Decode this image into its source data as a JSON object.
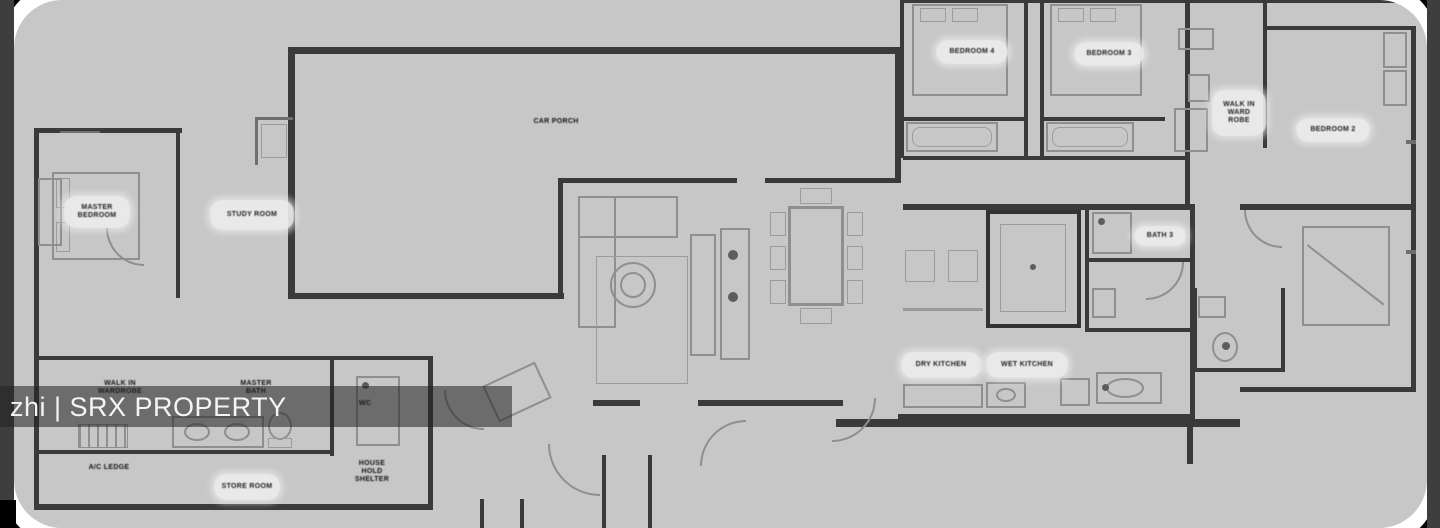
{
  "watermark": {
    "text": "zhi | SRX PROPERTY"
  },
  "plan": {
    "labels": {
      "hall": "CAR PORCH",
      "study": "STUDY ROOM",
      "master_bedroom": [
        "MASTER",
        "BEDROOM"
      ],
      "bedroom4": "BEDROOM 4",
      "bedroom3": "BEDROOM 3",
      "walkin_wardrobe_top": [
        "WALK IN",
        "WARD",
        "ROBE"
      ],
      "bedroom2": "BEDROOM 2",
      "bath3": "BATH 3",
      "dry_kitchen": "DRY KITCHEN",
      "wet_kitchen": "WET KITCHEN",
      "master_bath": [
        "MASTER",
        "BATH"
      ],
      "walkin_wardrobe_bottom": [
        "WALK IN",
        "WARDROBE"
      ],
      "wc": "WC",
      "ac_ledge": "A/C LEDGE",
      "store": "STORE ROOM",
      "household_shelter": [
        "HOUSE",
        "HOLD",
        "SHELTER"
      ]
    }
  }
}
